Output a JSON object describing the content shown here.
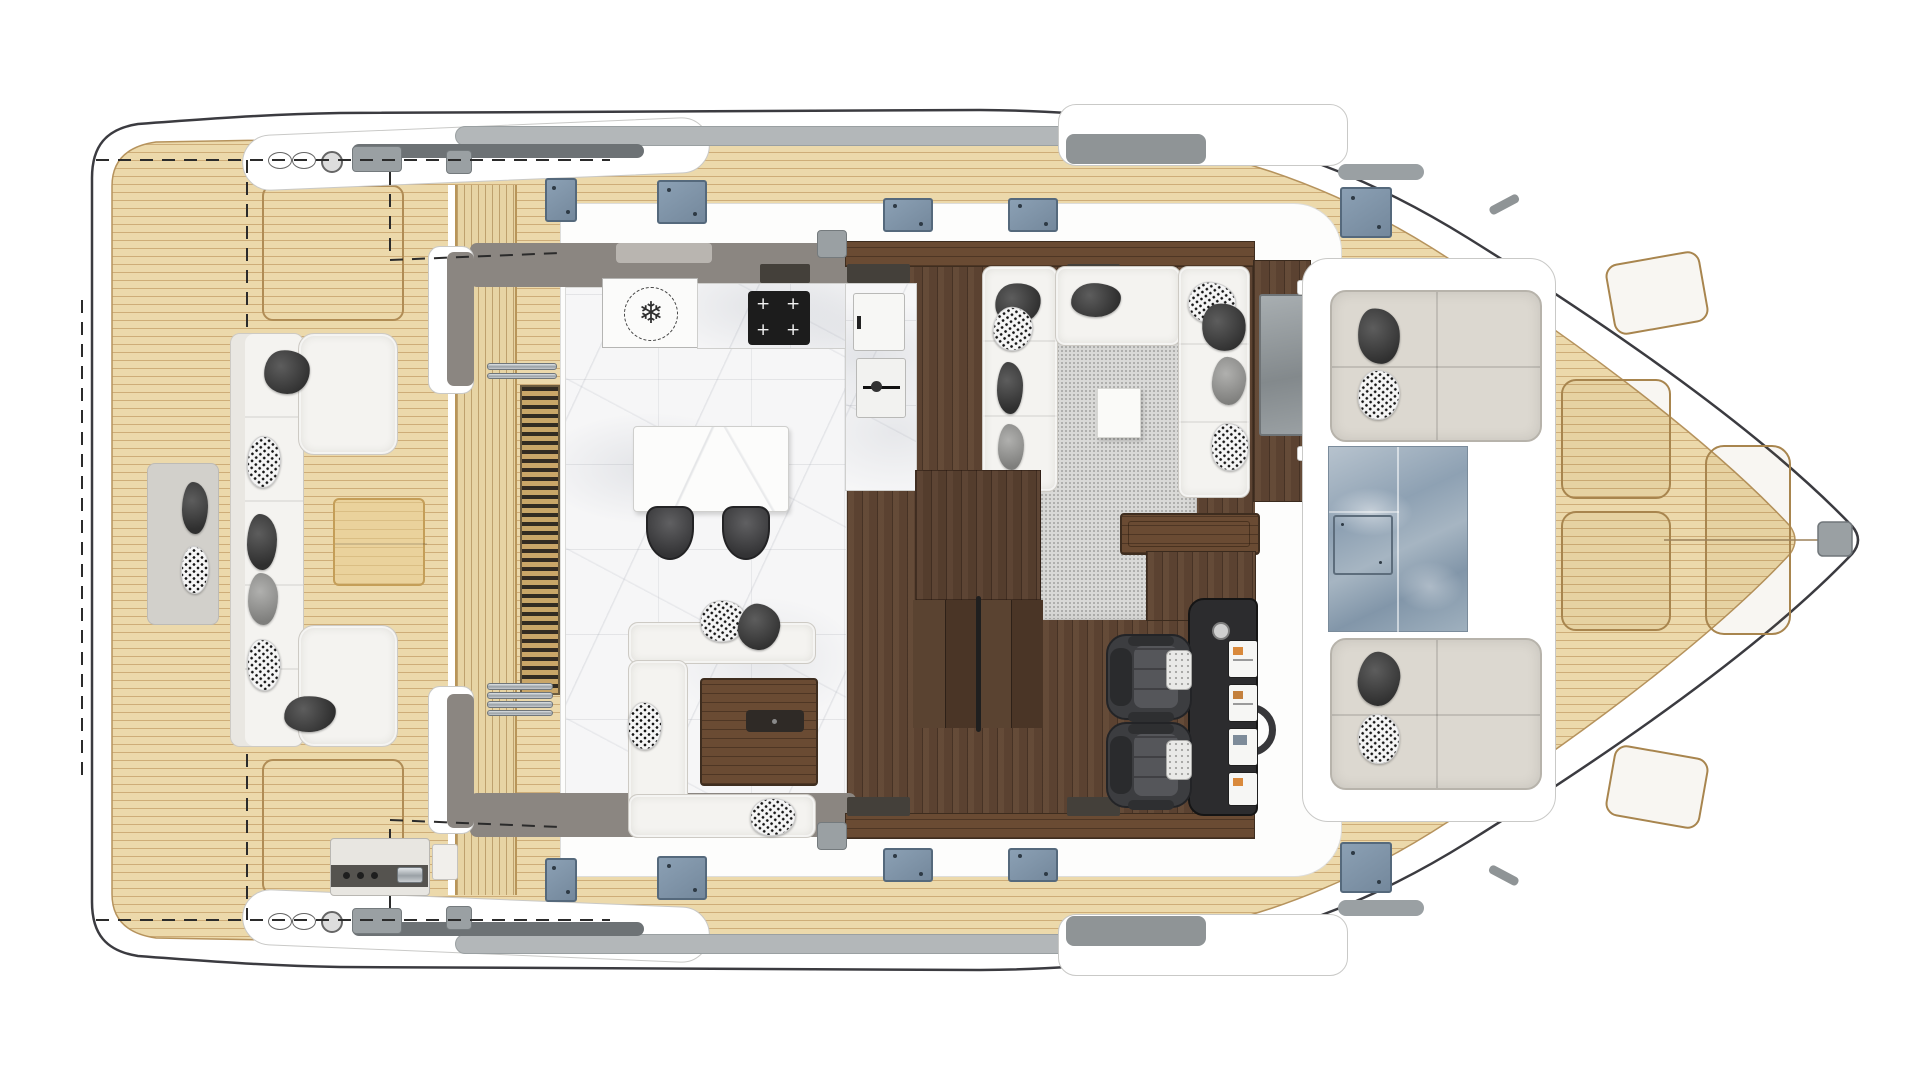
{
  "meta": {
    "description": "Top-view main-deck floor plan of a luxury power catamaran yacht",
    "background": "#ffffff",
    "orientation": "bow-right"
  },
  "glyphs": {
    "snowflake": "❄"
  },
  "palette": {
    "hull_outline": "#3b3b40",
    "teak": "#ecd9ab",
    "teak_line": "#c3a069",
    "walnut_floor": "#5b4231",
    "marble": "#f6f6f7",
    "wall_gray": "#8b8681",
    "window_dark": "#44403a",
    "hatch_blue": "#8195a9",
    "glass_blue": "#8fa2b5",
    "sofa_white": "#f4f3f0",
    "carpet_gray": "#d9d9d7",
    "cushion_dark": "#3f3f3f",
    "console_black": "#2c2c2e",
    "table_oak": "#ead29c",
    "steel": "#c8ccd0"
  },
  "areas": {
    "aft_deck": {
      "name": "aft-deck",
      "furniture": [
        "l-sofa",
        "chaise-top",
        "chaise-bottom",
        "oak-coffee-table",
        "lounger-mat",
        "outdoor-grill"
      ],
      "pillow_count": 8
    },
    "boarding": {
      "name": "side-boarding",
      "items": [
        "teak-steps",
        "deck-grate",
        "folding-ladder",
        "rail-bar"
      ]
    },
    "galley": {
      "name": "galley",
      "floor": "marble",
      "appliances": [
        "refrigerator-freezer",
        "cooktop",
        "sink",
        "storage-cabinet"
      ],
      "island_seats": 2
    },
    "dinette": {
      "name": "dinette",
      "furniture": [
        "u-sofa",
        "walnut-table"
      ],
      "pillow_count": 4
    },
    "salon": {
      "name": "salon",
      "floor": "walnut",
      "furniture": [
        "u-sofa",
        "cube-coffee-table",
        "area-rug",
        "walnut-bar",
        "tv-cabinet"
      ],
      "pillow_count": 9
    },
    "helm": {
      "name": "helm-station",
      "seats": 2,
      "displays": 4,
      "controls": [
        "steering-wheel",
        "throttle-knob"
      ]
    },
    "foredeck": {
      "name": "foredeck",
      "sun_pads": 2,
      "features": [
        "skylight-windshield",
        "glass-hatch",
        "storage-lockers",
        "anchor-roller"
      ]
    },
    "side_decks": {
      "name": "side-decks",
      "hatch_count": 10
    }
  }
}
